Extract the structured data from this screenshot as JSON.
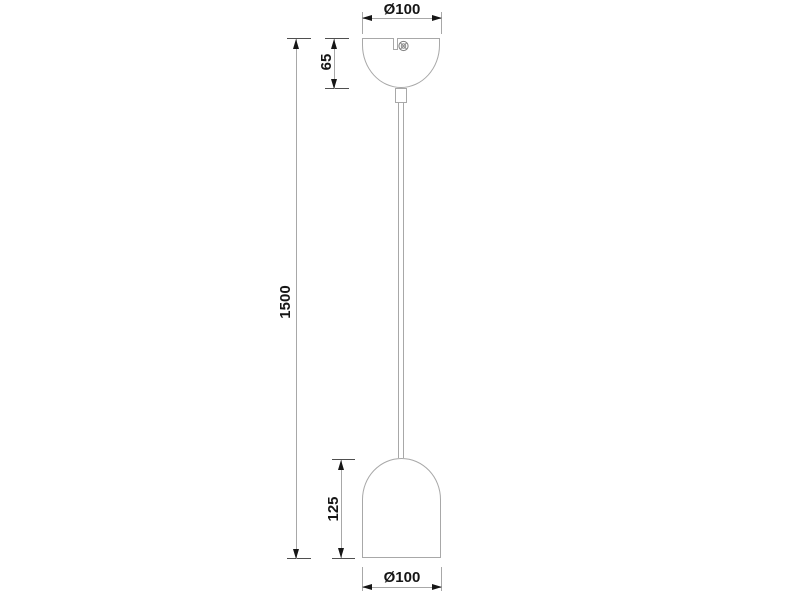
{
  "colors": {
    "background": "#ffffff",
    "line": "#a8a8a8",
    "tick": "#4f4f4f",
    "arrow": "#161616",
    "text": "#161616"
  },
  "dimensions": [
    {
      "id": "canopy-diameter",
      "label": "Ø100",
      "orientation": "horizontal",
      "position": "top"
    },
    {
      "id": "canopy-height",
      "label": "65",
      "orientation": "vertical",
      "position": "left-of-canopy"
    },
    {
      "id": "overall-drop-length",
      "label": "1500",
      "orientation": "vertical",
      "position": "far-left"
    },
    {
      "id": "shade-height",
      "label": "125",
      "orientation": "vertical",
      "position": "left-of-shade"
    },
    {
      "id": "shade-diameter",
      "label": "Ø100",
      "orientation": "horizontal",
      "position": "bottom"
    }
  ],
  "parts": [
    {
      "id": "ceiling-canopy"
    },
    {
      "id": "cable-lock-screw"
    },
    {
      "id": "strain-relief-grip"
    },
    {
      "id": "suspension-cable"
    },
    {
      "id": "lamp-shade"
    }
  ]
}
